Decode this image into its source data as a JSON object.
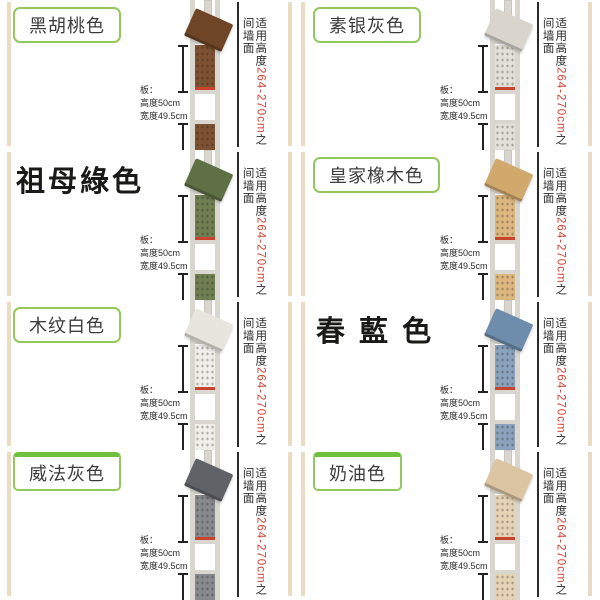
{
  "palette": {
    "label_border": "#94c75e",
    "label_text": "#3c3c3c",
    "big_label_text": "#1a1a17",
    "top_bar_green": "#6dbf3d",
    "wall_strip": "#e9dcc3",
    "pole": "#d9d6d0",
    "red_line": "#c8442e",
    "range_red": "#cf4436",
    "annotation_text": "#2b2b2b",
    "divider_line": "#2a2a2a"
  },
  "annotations": {
    "board_label": "板：",
    "board_height": "高度50cm",
    "board_width": "宽度49.5cm",
    "fit_prefix": "适用高度",
    "fit_range": "264-270cm",
    "fit_suffix": "之间墙面"
  },
  "cells": [
    {
      "label": "黑胡桃色",
      "style": "boxed",
      "topbar": false,
      "board_color": "#7d5232",
      "shelf_color": "#6e4527"
    },
    {
      "label": "素银灰色",
      "style": "boxed",
      "topbar": false,
      "board_color": "#e3e0d9",
      "shelf_color": "#d9d5cd"
    },
    {
      "label": "祖母綠色",
      "style": "large",
      "topbar": false,
      "board_color": "#6f7f52",
      "shelf_color": "#5f7047"
    },
    {
      "label": "皇家橡木色",
      "style": "boxed",
      "topbar": false,
      "board_color": "#dcb77f",
      "shelf_color": "#d2a96c"
    },
    {
      "label": "木纹白色",
      "style": "boxed",
      "topbar": false,
      "board_color": "#f0eeea",
      "shelf_color": "#e8e5df"
    },
    {
      "label": "春 藍 色",
      "style": "large",
      "topbar": false,
      "board_color": "#8aa2bc",
      "shelf_color": "#6e8dac"
    },
    {
      "label": "威法灰色",
      "style": "boxed",
      "topbar": true,
      "board_color": "#87898d",
      "shelf_color": "#5f6368"
    },
    {
      "label": "奶油色",
      "style": "boxed",
      "topbar": true,
      "board_color": "#e6d3b5",
      "shelf_color": "#dcc5a2"
    }
  ]
}
